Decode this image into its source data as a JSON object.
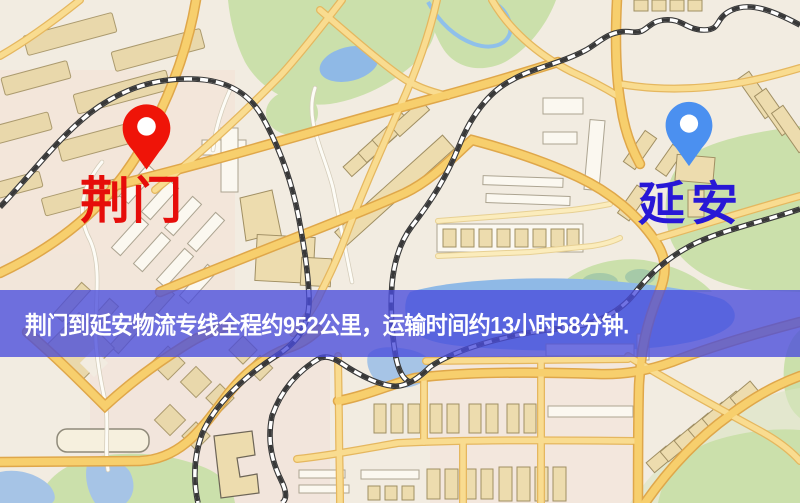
{
  "banner": {
    "text": "荆门到延安物流专线全程约952公里，运输时间约13小时58分钟.",
    "background_color": "#494bdb",
    "text_color": "#ffffff"
  },
  "markers": {
    "origin": {
      "label": "荆门",
      "icon": "red-pin-icon",
      "pin_color": "#ef1408",
      "label_color": "#e60d0a"
    },
    "destination": {
      "label": "延安",
      "icon": "blue-pin-icon",
      "pin_color": "#4b90f0",
      "label_color": "#2818d6"
    }
  },
  "map_colors": {
    "background": "#f2ece1",
    "road_fill": "#f7cf6d",
    "road_casing": "#dfa74a",
    "park_green": "#cbe0ab",
    "water_blue": "#8fb9e6",
    "building_tan": "#eddcae",
    "railway_dark": "#383838"
  }
}
